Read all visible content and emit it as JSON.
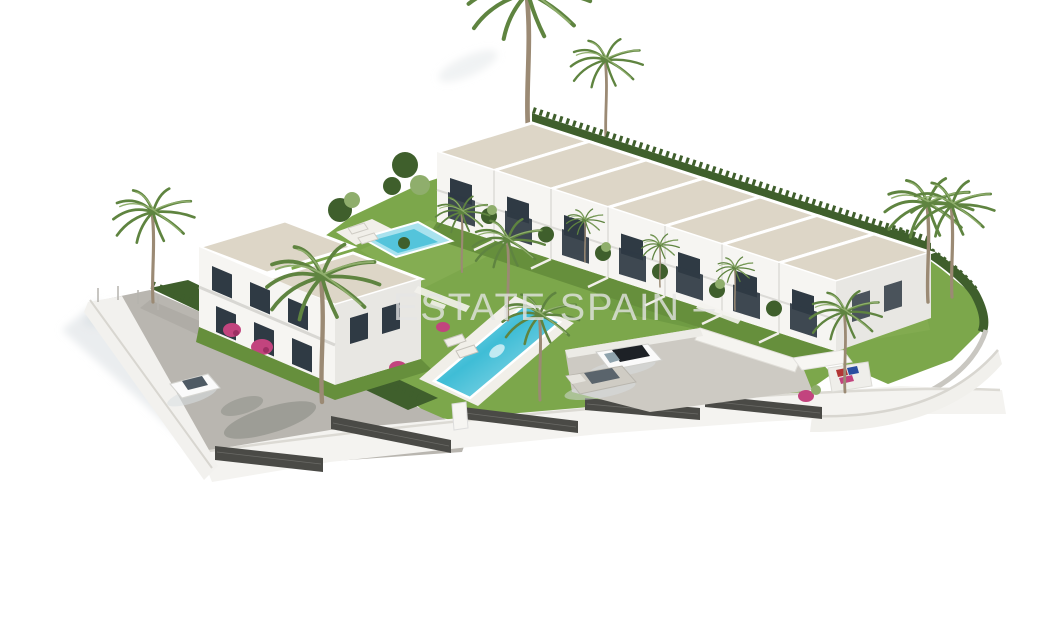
{
  "meta": {
    "description": "Aerial 3D architectural rendering of a new-build residential complex: a diagonal row of seven white townhouses with light stone pitched roofs and a back hedge, a two-storey white apartment house on the left, a long turquoise lap pool and a smaller garden pool, palm trees, lawns, a grey access road with a parked white car, a parking terrace with a white and a silver car, dark mesh perimeter fencing on white retaining walls, and a palm lawn on the right — all on a plain white background.",
    "background_color": "#ffffff"
  },
  "watermark": {
    "text": "ESTATE SPAIN –"
  },
  "inventory": {
    "townhouse_units": 7,
    "apartment_building": 1,
    "swimming_pools": 2,
    "parked_cars": 3,
    "sun_loungers": 4,
    "tall_palms_right_lawn": 2
  },
  "colors": {
    "roof": "#ddd6c7",
    "wall_white": "#f6f5f2",
    "wall_shade": "#e8e7e3",
    "window": "#2f3a44",
    "glass_light": "#8fa3ad",
    "grass": "#7ca74b",
    "grass_dark": "#668f3c",
    "hedge": "#3f5f2c",
    "pool_deep": "#3fbdd6",
    "pool_light": "#a9e2ee",
    "deck": "#f1efe9",
    "road": "#b9b6b0",
    "parking": "#cdcac3",
    "fence_dark": "#4a4a46",
    "palm_trunk": "#9b8a74",
    "palm_frond": "#5f8440",
    "palm_frond_light": "#8fae6c",
    "bougainvillea": "#c2447e",
    "car_white": "#fafafa",
    "car_silver": "#cfccc4",
    "car_dark_roof": "#1d2126",
    "shadow": "#d9dee2",
    "watermark_color": "rgba(229,229,229,0.78)"
  }
}
